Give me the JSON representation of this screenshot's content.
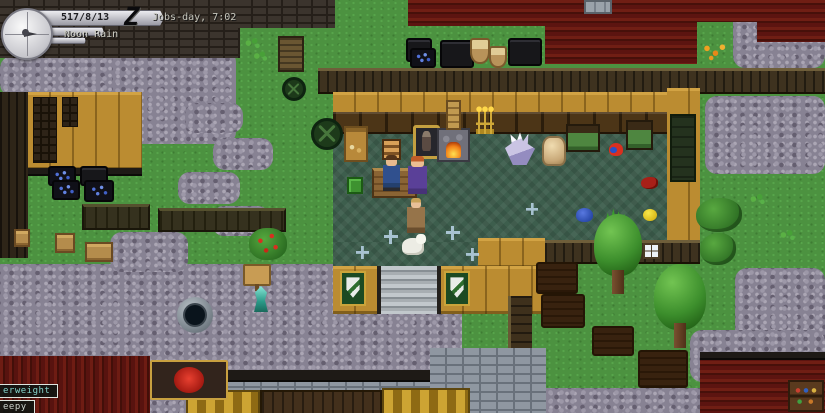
{
  "hud": {
    "date": "517/8/13",
    "calendar": "Jobs-day, 7:02",
    "weather": "Noon Rain",
    "logo_letter": "Z",
    "compass_icon": "compass-clock-dial"
  },
  "status_effects": [
    {
      "label": "erweight",
      "color": "#86d4cc"
    },
    {
      "label": "eepy",
      "color": "#ccd2cc"
    }
  ],
  "colors": {
    "grass": "#4c9240",
    "cobblestone": "#878293",
    "roof_red": "#5c1410",
    "wall_tan": "#bb8c31",
    "shop_floor": "#3d5e4d",
    "badge_border": "#dfe5df"
  },
  "entities": [
    {
      "name": "storage-bin",
      "type": "bin-dark",
      "x": 406,
      "y": 38,
      "w": 26,
      "h": 24,
      "interactable": true
    },
    {
      "name": "berry-bin",
      "type": "bin-berries",
      "x": 410,
      "y": 48,
      "w": 26,
      "h": 20,
      "interactable": true
    },
    {
      "name": "storage-bin",
      "type": "bin-dark",
      "x": 440,
      "y": 40,
      "w": 34,
      "h": 28,
      "interactable": true
    },
    {
      "name": "produce-basket",
      "type": "basket",
      "x": 470,
      "y": 38,
      "w": 20,
      "h": 26,
      "interactable": true
    },
    {
      "name": "produce-basket",
      "type": "basket",
      "x": 489,
      "y": 46,
      "w": 18,
      "h": 22,
      "interactable": true
    },
    {
      "name": "storage-bin",
      "type": "bin-dark",
      "x": 508,
      "y": 38,
      "w": 34,
      "h": 28,
      "interactable": true
    },
    {
      "name": "berry-bin",
      "type": "bin-berries",
      "x": 48,
      "y": 166,
      "w": 28,
      "h": 20,
      "interactable": true
    },
    {
      "name": "berry-bin",
      "type": "bin-berries",
      "x": 52,
      "y": 180,
      "w": 28,
      "h": 20,
      "interactable": true
    },
    {
      "name": "storage-bin",
      "type": "bin-dark",
      "x": 80,
      "y": 166,
      "w": 28,
      "h": 20,
      "interactable": true
    },
    {
      "name": "berry-bin",
      "type": "bin-berries",
      "x": 84,
      "y": 180,
      "w": 30,
      "h": 22,
      "interactable": true
    },
    {
      "name": "market-table",
      "type": "table-long",
      "x": 82,
      "y": 204,
      "w": 68,
      "h": 26,
      "interactable": true
    },
    {
      "name": "market-table",
      "type": "table-long",
      "x": 158,
      "y": 208,
      "w": 128,
      "h": 24,
      "interactable": true
    },
    {
      "name": "wooden-crate",
      "type": "crate",
      "x": 55,
      "y": 233,
      "w": 20,
      "h": 20,
      "interactable": true
    },
    {
      "name": "wooden-crate",
      "type": "crate",
      "x": 85,
      "y": 242,
      "w": 28,
      "h": 20,
      "interactable": true
    },
    {
      "name": "wooden-crate",
      "type": "crate",
      "x": 14,
      "y": 229,
      "w": 16,
      "h": 18,
      "interactable": true
    },
    {
      "name": "cart-wheel",
      "type": "wheel",
      "x": 282,
      "y": 77,
      "w": 24,
      "h": 24,
      "interactable": false
    },
    {
      "name": "cart-wheel",
      "type": "wheel",
      "x": 311,
      "y": 118,
      "w": 32,
      "h": 32,
      "interactable": false
    },
    {
      "name": "berry-bush",
      "type": "bush-red",
      "x": 249,
      "y": 228,
      "w": 38,
      "h": 32,
      "interactable": true
    },
    {
      "name": "signpost",
      "type": "sign",
      "x": 243,
      "y": 264,
      "w": 28,
      "h": 22,
      "interactable": true
    },
    {
      "name": "gem-statue",
      "type": "statue-cyan",
      "x": 251,
      "y": 286,
      "w": 20,
      "h": 26,
      "interactable": true
    },
    {
      "name": "stone-well",
      "type": "well",
      "x": 177,
      "y": 297,
      "w": 36,
      "h": 36,
      "interactable": true
    },
    {
      "name": "goods-stall",
      "type": "stall",
      "x": 344,
      "y": 126,
      "w": 24,
      "h": 36,
      "interactable": true
    },
    {
      "name": "green-supply-crate",
      "type": "green-crate",
      "x": 347,
      "y": 177,
      "w": 16,
      "h": 17,
      "interactable": true
    },
    {
      "name": "bread-rack",
      "type": "bread-rack",
      "x": 382,
      "y": 139,
      "w": 19,
      "h": 21,
      "interactable": true
    },
    {
      "name": "armor-stand",
      "type": "armor-stand",
      "x": 413,
      "y": 125,
      "w": 27,
      "h": 34,
      "interactable": true
    },
    {
      "name": "shop-counter",
      "type": "counter",
      "x": 372,
      "y": 168,
      "w": 45,
      "h": 30,
      "interactable": true
    },
    {
      "name": "shopkeeper-npc",
      "type": "man-blue",
      "x": 383,
      "y": 155,
      "w": 17,
      "h": 36,
      "interactable": true
    },
    {
      "name": "robed-woman-npc",
      "type": "woman-purple",
      "x": 408,
      "y": 156,
      "w": 19,
      "h": 38,
      "interactable": true
    },
    {
      "name": "fireplace",
      "type": "fireplace",
      "x": 437,
      "y": 128,
      "w": 33,
      "h": 34,
      "interactable": true
    },
    {
      "name": "chimney",
      "type": "chimney-tan",
      "x": 446,
      "y": 100,
      "w": 15,
      "h": 30,
      "interactable": false
    },
    {
      "name": "candelabra",
      "type": "candelabra",
      "x": 476,
      "y": 108,
      "w": 18,
      "h": 26,
      "interactable": false
    },
    {
      "name": "crystal-cluster",
      "type": "crystal",
      "x": 505,
      "y": 131,
      "w": 30,
      "h": 34,
      "interactable": true
    },
    {
      "name": "grain-sack",
      "type": "sack",
      "x": 542,
      "y": 136,
      "w": 24,
      "h": 30,
      "interactable": true
    },
    {
      "name": "bed",
      "type": "bed-green",
      "x": 566,
      "y": 124,
      "w": 34,
      "h": 28,
      "interactable": true
    },
    {
      "name": "bed",
      "type": "bed-green",
      "x": 626,
      "y": 120,
      "w": 27,
      "h": 30,
      "interactable": true
    },
    {
      "name": "parrot",
      "type": "parrot",
      "x": 609,
      "y": 143,
      "w": 14,
      "h": 13,
      "interactable": true
    },
    {
      "name": "red-bird",
      "type": "red-bird",
      "x": 641,
      "y": 177,
      "w": 17,
      "h": 12,
      "interactable": true
    },
    {
      "name": "child-npc",
      "type": "child",
      "x": 407,
      "y": 198,
      "w": 18,
      "h": 35,
      "interactable": true
    },
    {
      "name": "goat-animal",
      "type": "goat",
      "x": 402,
      "y": 238,
      "w": 22,
      "h": 17,
      "interactable": true
    },
    {
      "name": "blue-slime",
      "type": "slime",
      "x": 576,
      "y": 208,
      "w": 17,
      "h": 14,
      "interactable": true
    },
    {
      "name": "spiky-plant",
      "type": "plant-spiky",
      "x": 605,
      "y": 206,
      "w": 22,
      "h": 17,
      "interactable": true
    },
    {
      "name": "lemon-item",
      "type": "lemon",
      "x": 643,
      "y": 209,
      "w": 14,
      "h": 12,
      "interactable": true
    },
    {
      "name": "floor-sparkle",
      "type": "sparkle",
      "x": 384,
      "y": 230,
      "w": 14,
      "h": 14,
      "interactable": false
    },
    {
      "name": "floor-sparkle",
      "type": "sparkle",
      "x": 446,
      "y": 226,
      "w": 14,
      "h": 14,
      "interactable": false
    },
    {
      "name": "floor-sparkle",
      "type": "sparkle",
      "x": 356,
      "y": 246,
      "w": 13,
      "h": 13,
      "interactable": false
    },
    {
      "name": "floor-sparkle",
      "type": "sparkle",
      "x": 466,
      "y": 248,
      "w": 13,
      "h": 13,
      "interactable": false
    },
    {
      "name": "floor-sparkle",
      "type": "sparkle",
      "x": 526,
      "y": 203,
      "w": 12,
      "h": 12,
      "interactable": false
    },
    {
      "name": "crest-banner",
      "type": "banner",
      "x": 340,
      "y": 271,
      "w": 26,
      "h": 35,
      "interactable": false
    },
    {
      "name": "crest-banner",
      "type": "banner",
      "x": 444,
      "y": 271,
      "w": 26,
      "h": 35,
      "interactable": false
    },
    {
      "name": "wall-window",
      "type": "window-grid",
      "x": 643,
      "y": 243,
      "w": 17,
      "h": 16,
      "interactable": false
    },
    {
      "name": "oak-tree",
      "type": "tree",
      "x": 594,
      "y": 214,
      "w": 48,
      "h": 80,
      "interactable": true
    },
    {
      "name": "oak-tree",
      "type": "tree",
      "x": 654,
      "y": 264,
      "w": 52,
      "h": 84,
      "interactable": true
    },
    {
      "name": "bush",
      "type": "bush",
      "x": 696,
      "y": 198,
      "w": 46,
      "h": 34,
      "interactable": true
    },
    {
      "name": "bush",
      "type": "bush",
      "x": 700,
      "y": 233,
      "w": 36,
      "h": 32,
      "interactable": true
    },
    {
      "name": "dirt-plot",
      "type": "soil",
      "x": 536,
      "y": 262,
      "w": 42,
      "h": 32,
      "interactable": false
    },
    {
      "name": "dirt-plot",
      "type": "soil",
      "x": 541,
      "y": 294,
      "w": 44,
      "h": 34,
      "interactable": false
    },
    {
      "name": "dirt-plot",
      "type": "soil",
      "x": 592,
      "y": 326,
      "w": 42,
      "h": 30,
      "interactable": false
    },
    {
      "name": "dirt-plot",
      "type": "soil",
      "x": 638,
      "y": 350,
      "w": 50,
      "h": 38,
      "interactable": false
    },
    {
      "name": "flower-patch",
      "type": "flowers",
      "x": 700,
      "y": 40,
      "w": 28,
      "h": 24,
      "interactable": false
    },
    {
      "name": "bookshelf",
      "type": "bookshelf",
      "x": 788,
      "y": 380,
      "w": 36,
      "h": 32,
      "interactable": true
    },
    {
      "name": "shop-signboard",
      "type": "sign-board",
      "x": 150,
      "y": 360,
      "w": 78,
      "h": 40,
      "interactable": true
    },
    {
      "name": "grass-plant",
      "type": "plant-small",
      "x": 243,
      "y": 36,
      "w": 18,
      "h": 14,
      "interactable": false
    },
    {
      "name": "grass-plant",
      "type": "plant-small",
      "x": 252,
      "y": 50,
      "w": 16,
      "h": 12,
      "interactable": false
    },
    {
      "name": "grass-plant",
      "type": "plant-small",
      "x": 748,
      "y": 192,
      "w": 18,
      "h": 14,
      "interactable": false
    },
    {
      "name": "grass-plant",
      "type": "plant-small",
      "x": 778,
      "y": 228,
      "w": 18,
      "h": 14,
      "interactable": false
    }
  ]
}
